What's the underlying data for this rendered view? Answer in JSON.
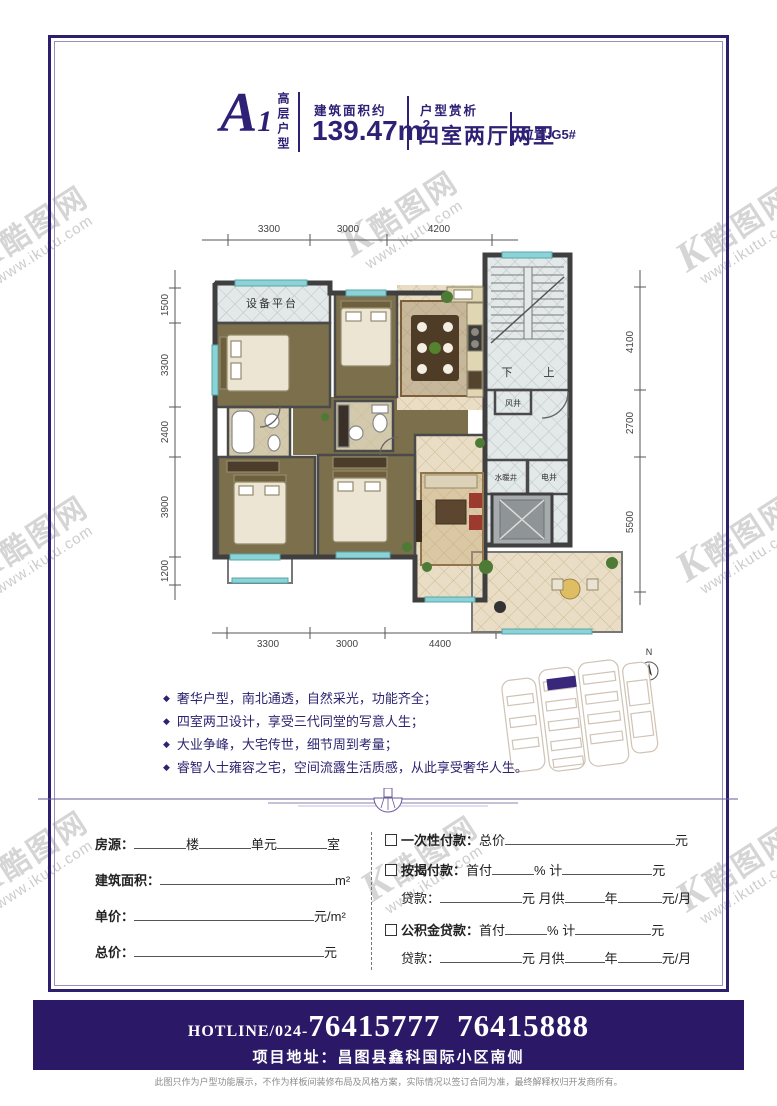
{
  "watermark": {
    "k": "K",
    "logo": "酷图网",
    "url": "www.ikutu.com"
  },
  "header": {
    "unit_code_letter": "A",
    "unit_code_number": "1",
    "unit_type_vertical": "高层户型",
    "area_label": "建筑面积约",
    "area_value": "139.47m",
    "area_sup": "2",
    "appreciation_label": "户型赏析",
    "layout_value": "四室两厅两卫",
    "location": "位置:G5#"
  },
  "plan": {
    "dims": {
      "top": [
        "3300",
        "3000",
        "4200"
      ],
      "bottom": [
        "3300",
        "3000",
        "4400"
      ],
      "left": [
        "1500",
        "3300",
        "2400",
        "3900",
        "1200"
      ],
      "right": [
        "4100",
        "2700",
        "5500"
      ]
    },
    "labels": {
      "platform": "设备平台",
      "down": "下",
      "up": "上",
      "wind_shaft": "风井",
      "plumbing_shaft": "水暖井",
      "electric_shaft": "电井"
    },
    "compass": "N"
  },
  "features_bullet": "◆",
  "features": [
    "奢华户型，南北通透，自然采光，功能齐全；",
    "四室两卫设计，享受三代同堂的写意人生；",
    "大业争峰，大宅传世，细节周到考量；",
    "睿智人士雍容之宅，空间流露生活质感，从此享受奢华人生。"
  ],
  "form": {
    "left": {
      "housing_label": "房源：",
      "building_suffix": "楼",
      "unit_suffix": "单元",
      "room_suffix": "室",
      "area_label": "建筑面积：",
      "area_unit": "m²",
      "unit_price_label": "单价：",
      "unit_price_unit": "元/m²",
      "total_label": "总价：",
      "total_unit": "元"
    },
    "right": {
      "onetime_label": "一次性付款：",
      "onetime_prefix": "总价",
      "mortgage_label": "按揭付款：",
      "fund_label": "公积金贷款：",
      "down_payment": "首付",
      "percent": "%",
      "ji": "计",
      "loan_label": "贷款：",
      "monthly": "月供",
      "year": "年",
      "yuan": "元",
      "yuan_month": "元/月"
    }
  },
  "footer": {
    "hotline_prefix": "HOTLINE/024-",
    "hotline_numbers": "76415777 76415888",
    "address": "项目地址：昌图县鑫科国际小区南侧",
    "disclaimer": "此图只作为户型功能展示，不作为样板间装修布局及风格方案，实际情况以签订合同为准，最终解释权归开发商所有。"
  },
  "colors": {
    "brand": "#2e2175",
    "band": "#2b1967",
    "window_teal": "#8bd3d7"
  }
}
